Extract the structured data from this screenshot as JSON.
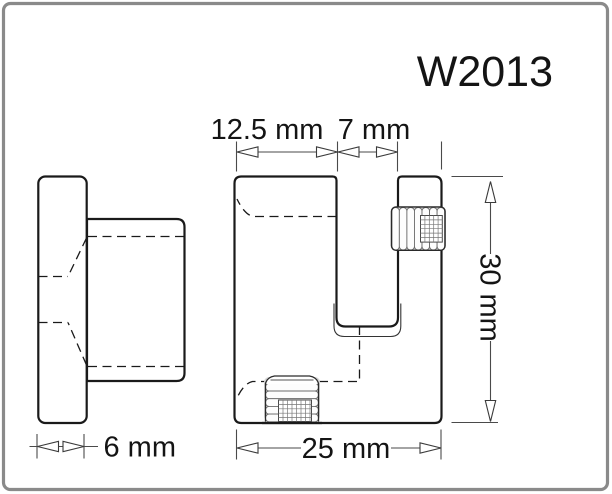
{
  "title": "W2013",
  "dimensions": {
    "slot_offset": "12.5 mm",
    "slot_width": "7 mm",
    "height": "30 mm",
    "width": "25 mm",
    "thickness": "6 mm"
  },
  "colors": {
    "outline": "#1a1a1a",
    "dimension_line": "#4a4a4a",
    "border": "#8a8a8a",
    "thread_shading": "#d7d7d7",
    "background": "#ffffff"
  }
}
